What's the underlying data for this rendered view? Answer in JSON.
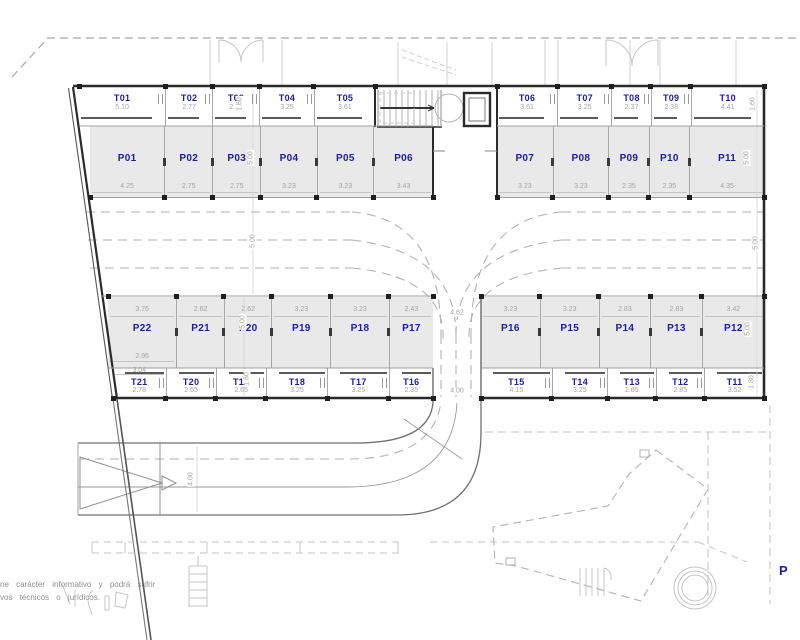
{
  "drawing": {
    "corner_label": "P",
    "disclaimer_line1": "ne carácter informativo y podrá sufrir",
    "disclaimer_line2": "vos técnicos o jurídicos."
  },
  "colors": {
    "unit_label_blue": "#1c1ca8",
    "dimension_gray": "#a3a3a3",
    "stall_fill": "#e9e9e9",
    "wall_dark": "#2b2b2b"
  },
  "units": {
    "top_storage_left": [
      {
        "id": "T01",
        "width": "5.10"
      },
      {
        "id": "T02",
        "width": "2.77"
      },
      {
        "id": "T03",
        "width": "2.78"
      },
      {
        "id": "T04",
        "width": "3.25"
      },
      {
        "id": "T05",
        "width": "3.61"
      }
    ],
    "top_parking_left": [
      {
        "id": "P01",
        "width": "4.25"
      },
      {
        "id": "P02",
        "width": "2.75"
      },
      {
        "id": "P03",
        "width": "2.75"
      },
      {
        "id": "P04",
        "width": "3.23"
      },
      {
        "id": "P05",
        "width": "3.23"
      },
      {
        "id": "P06",
        "width": "3.43"
      }
    ],
    "top_storage_right": [
      {
        "id": "T06",
        "width": "3.61"
      },
      {
        "id": "T07",
        "width": "3.25"
      },
      {
        "id": "T08",
        "width": "2.37"
      },
      {
        "id": "T09",
        "width": "2.38"
      },
      {
        "id": "T10",
        "width": "4.41"
      }
    ],
    "top_parking_right": [
      {
        "id": "P07",
        "width": "3.23"
      },
      {
        "id": "P08",
        "width": "3.23"
      },
      {
        "id": "P09",
        "width": "2.35"
      },
      {
        "id": "P10",
        "width": "2.35"
      },
      {
        "id": "P11",
        "width": "4.35"
      }
    ],
    "bottom_parking_left": [
      {
        "id": "P22",
        "width": "3.76",
        "width_bottom": "2.96"
      },
      {
        "id": "P21",
        "width": "2.62"
      },
      {
        "id": "P20",
        "width": "2.62"
      },
      {
        "id": "P19",
        "width": "3.23"
      },
      {
        "id": "P18",
        "width": "3.23"
      },
      {
        "id": "P17",
        "width": "2.43"
      }
    ],
    "bottom_storage_left": [
      {
        "id": "T21",
        "width": "2.78",
        "width_top": "3.04"
      },
      {
        "id": "T20",
        "width": "2.65"
      },
      {
        "id": "T19",
        "width": "2.65"
      },
      {
        "id": "T18",
        "width": "3.25"
      },
      {
        "id": "T17",
        "width": "3.25"
      },
      {
        "id": "T16",
        "width": "2.35"
      }
    ],
    "bottom_parking_right": [
      {
        "id": "P16",
        "width": "3.23"
      },
      {
        "id": "P15",
        "width": "3.23"
      },
      {
        "id": "P14",
        "width": "2.83"
      },
      {
        "id": "P13",
        "width": "2.83"
      },
      {
        "id": "P12",
        "width": "3.42"
      }
    ],
    "bottom_storage_right": [
      {
        "id": "T15",
        "width": "4.15"
      },
      {
        "id": "T14",
        "width": "3.25"
      },
      {
        "id": "T13",
        "width": "2.85"
      },
      {
        "id": "T12",
        "width": "2.85"
      },
      {
        "id": "T11",
        "width": "3.52"
      }
    ]
  },
  "dimensions": [
    {
      "name": "t03-depth",
      "text": "1.60"
    },
    {
      "name": "p03-depth",
      "text": "5.00"
    },
    {
      "name": "aisle-width-left",
      "text": "5.00"
    },
    {
      "name": "p20-depth",
      "text": "5.00"
    },
    {
      "name": "t19-depth",
      "text": "1.80"
    },
    {
      "name": "t10-depth",
      "text": "1.60"
    },
    {
      "name": "p11-depth",
      "text": "5.00"
    },
    {
      "name": "aisle-width-right",
      "text": "5.00"
    },
    {
      "name": "p12-depth",
      "text": "5.00"
    },
    {
      "name": "t11-depth",
      "text": "1.80"
    },
    {
      "name": "road-width",
      "text": "4.00"
    },
    {
      "name": "ramp-width",
      "text": "4.62"
    },
    {
      "name": "ramp-exit-width",
      "text": "4.00"
    }
  ]
}
